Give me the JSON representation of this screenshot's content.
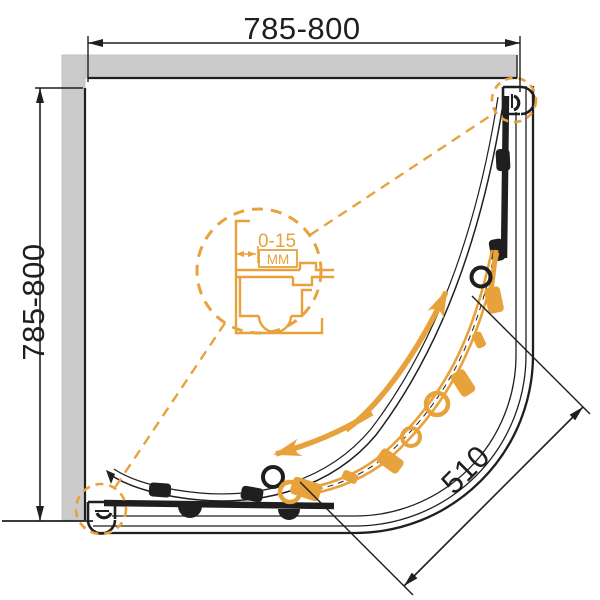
{
  "drawing": {
    "kind": "quadrant shower enclosure plan",
    "dimensions": {
      "top_width": "785-800",
      "left_depth": "785-800",
      "door_opening": "510",
      "adjustment_range": "0-15",
      "adjustment_unit": "MM"
    },
    "colors": {
      "accent_orange": "#e8a23c",
      "line_black": "#1f1f1f",
      "wall_gray": "#cbcbcb"
    }
  }
}
